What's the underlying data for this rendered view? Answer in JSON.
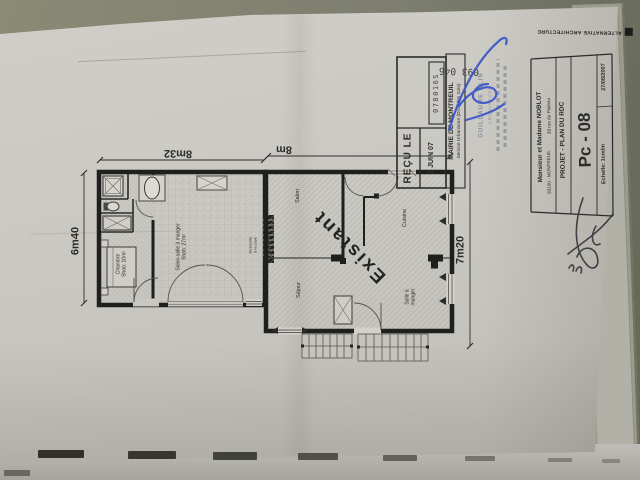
{
  "colors": {
    "background_olive": "#7d7e6e",
    "paper": "#cbc9c3",
    "ink": "#1f1f1e",
    "signature_blue": "#3752c9"
  },
  "plan": {
    "dimensions": {
      "left_width": "8m32",
      "right_width": "8m",
      "left_depth": "6m40",
      "right_depth": "7m20"
    },
    "rooms": {
      "chambre": {
        "name": "Chambre",
        "area": "Shab: 10m²"
      },
      "salon_sam": {
        "name": "Salon-salle à manger",
        "area": "Shab: 27m²"
      },
      "descente": {
        "line1": "Descente",
        "line2": "à la cave"
      },
      "salon": "Salon",
      "cuisine": "Cuisine",
      "sejour": "Séjour",
      "salle_a_manger": {
        "line1": "Salle à",
        "line2": "manger"
      },
      "existant": "Existant"
    }
  },
  "stamp": {
    "recu_le": "REÇU LE",
    "date": "2 JUIN 07",
    "number_top": "093 046",
    "number_box": "078016S",
    "mairie_line1": "MAIRIE DE MONTREUIL",
    "mairie_line2": "Service Urbanisme (Droit des Sols)"
  },
  "architect_stamp": {
    "line1": "GUILLAUME CLIN",
    "line2": "ARCHITECTE"
  },
  "title_block": {
    "logo": "ALTERNATIVE ARCHITECTURE",
    "client": "Monsieur et Madame NOBLOT",
    "address1": "38 rue du Plateau",
    "address2": "93100 - MONTREUIL",
    "project": "PROJET - PLAN DU RDC",
    "sheet": "Pc - 08",
    "scale": "Echelle: 1cm/m",
    "date": "27/06/2007"
  }
}
